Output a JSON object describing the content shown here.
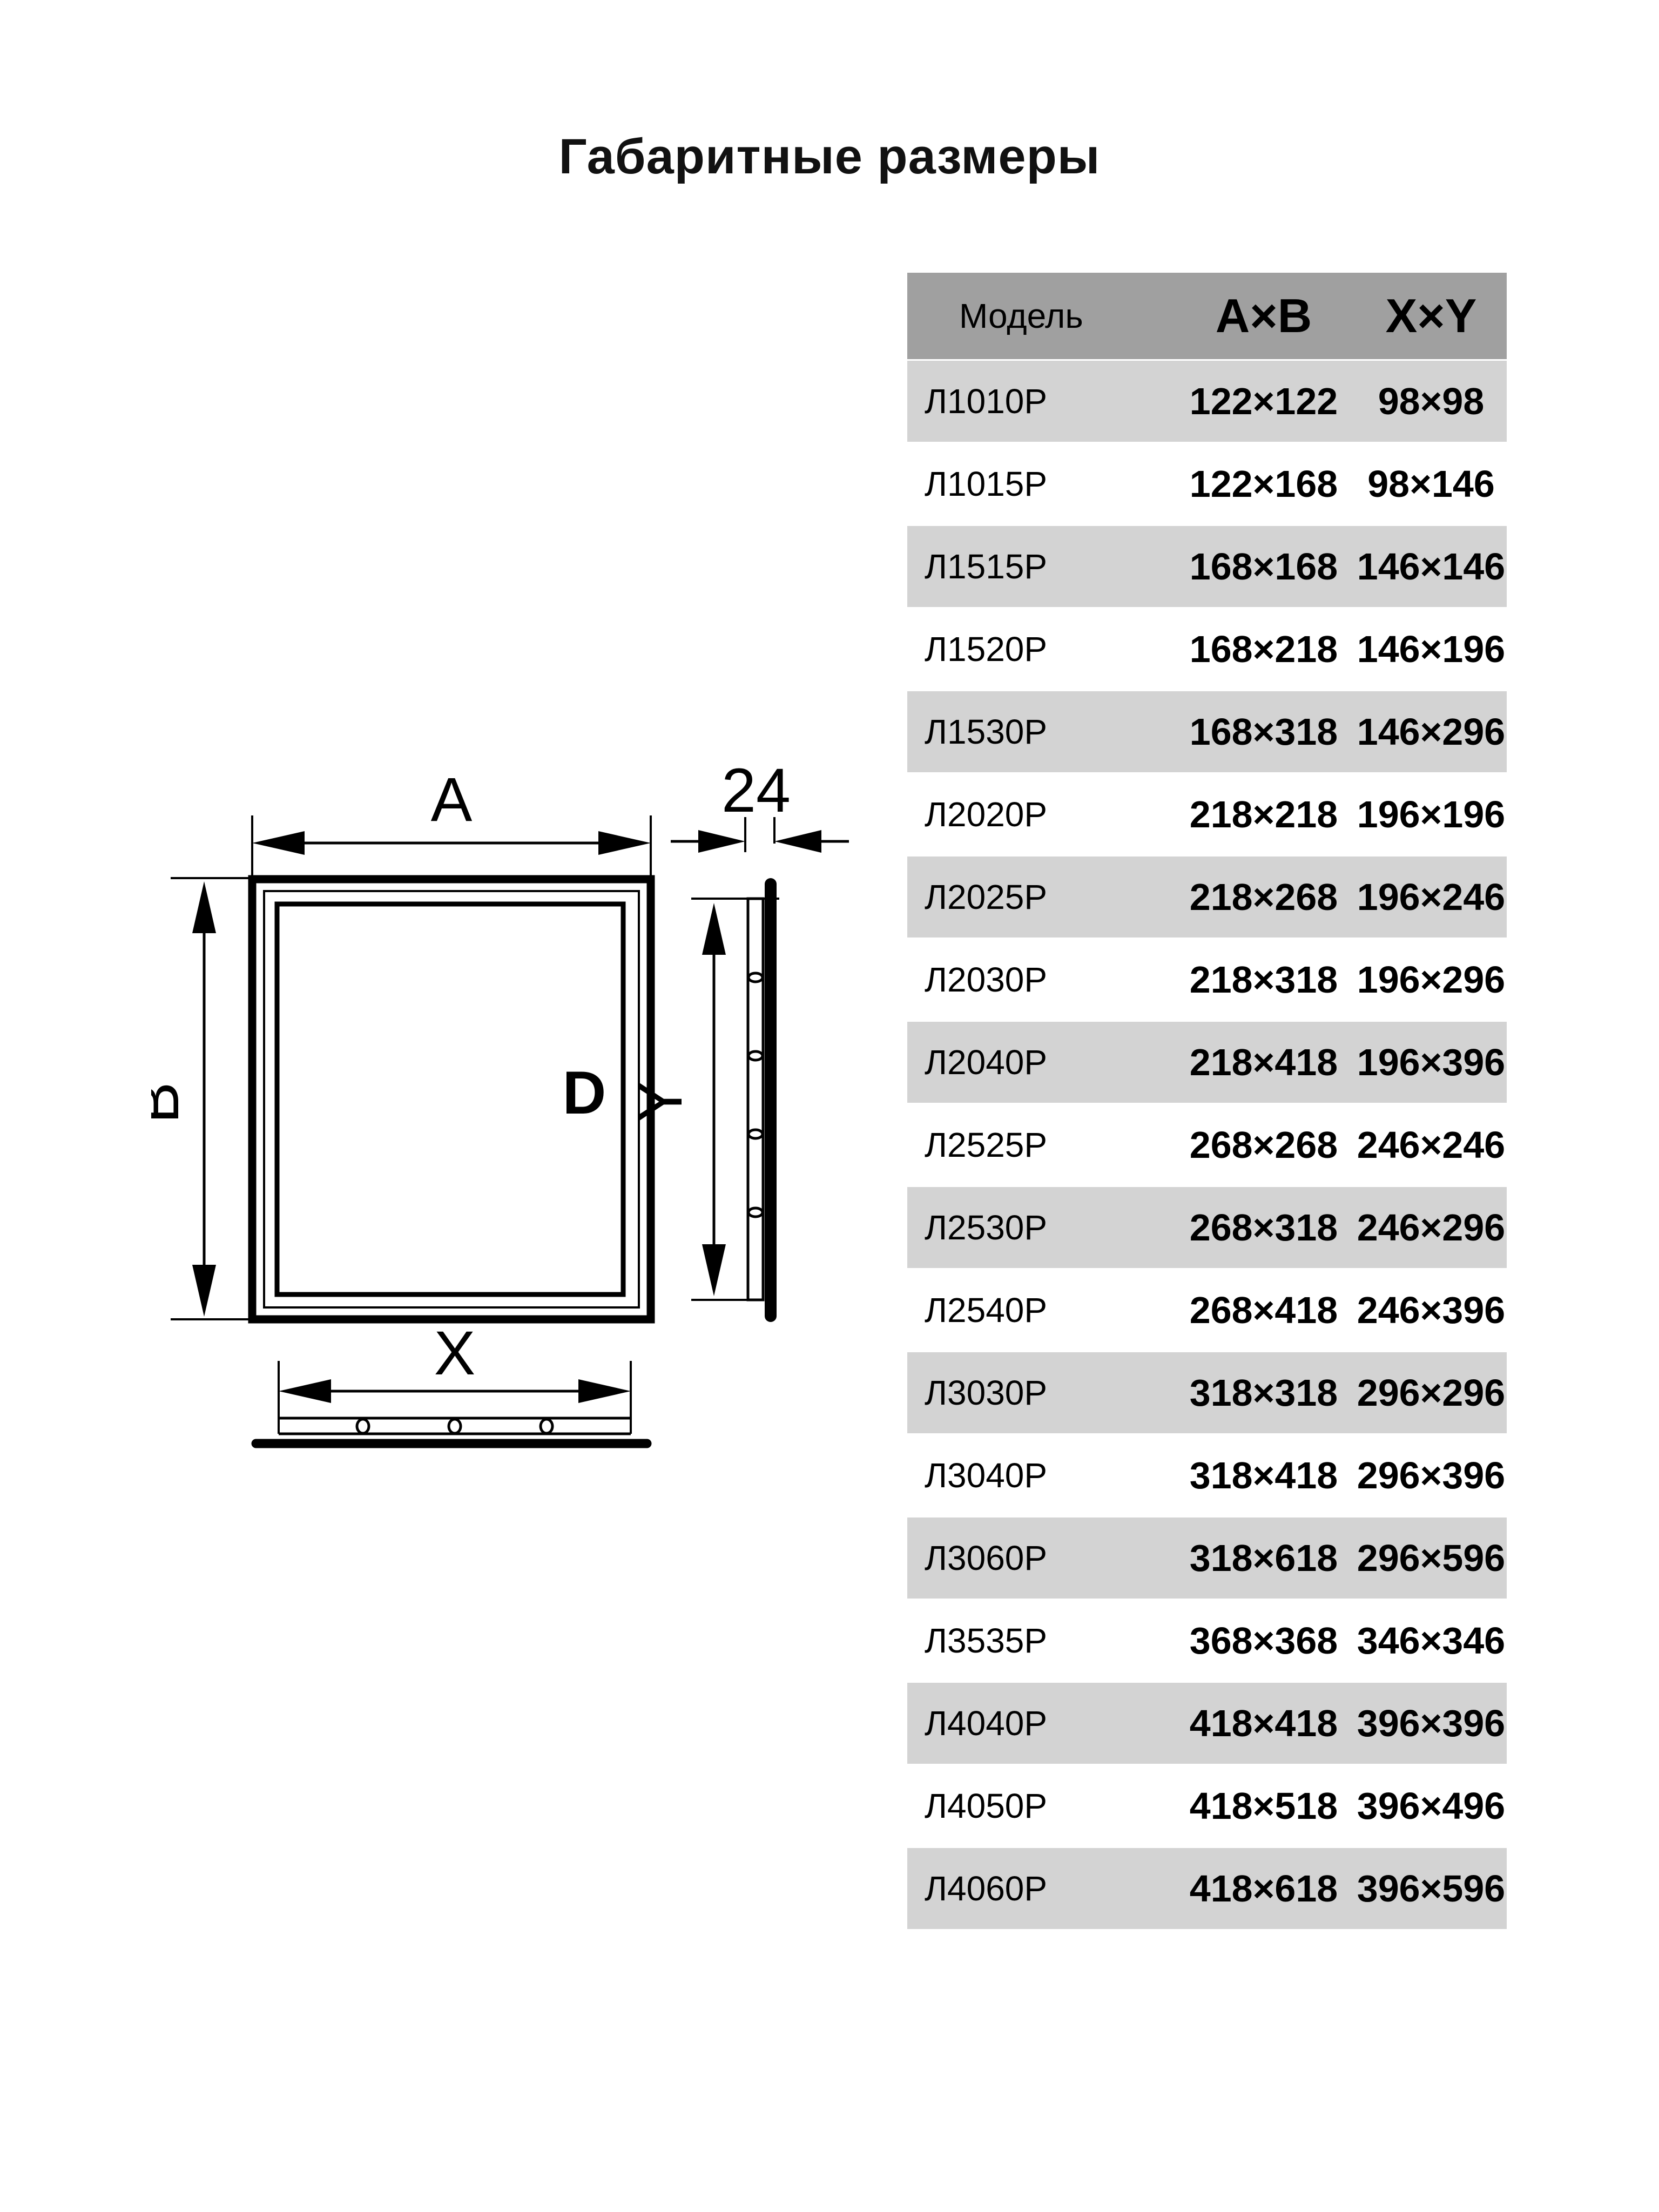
{
  "title": "Габаритные размеры",
  "table": {
    "columns": {
      "model": "Модель",
      "ab": "A×B",
      "xy": "X×Y"
    },
    "rows": [
      {
        "model": "Л1010Р",
        "ab": "122×122",
        "xy": "98×98"
      },
      {
        "model": "Л1015Р",
        "ab": "122×168",
        "xy": "98×146"
      },
      {
        "model": "Л1515Р",
        "ab": "168×168",
        "xy": "146×146"
      },
      {
        "model": "Л1520Р",
        "ab": "168×218",
        "xy": "146×196"
      },
      {
        "model": "Л1530Р",
        "ab": "168×318",
        "xy": "146×296"
      },
      {
        "model": "Л2020Р",
        "ab": "218×218",
        "xy": "196×196"
      },
      {
        "model": "Л2025Р",
        "ab": "218×268",
        "xy": "196×246"
      },
      {
        "model": "Л2030Р",
        "ab": "218×318",
        "xy": "196×296"
      },
      {
        "model": "Л2040Р",
        "ab": "218×418",
        "xy": "196×396"
      },
      {
        "model": "Л2525Р",
        "ab": "268×268",
        "xy": "246×246"
      },
      {
        "model": "Л2530Р",
        "ab": "268×318",
        "xy": "246×296"
      },
      {
        "model": "Л2540Р",
        "ab": "268×418",
        "xy": "246×396"
      },
      {
        "model": "Л3030Р",
        "ab": "318×318",
        "xy": "296×296"
      },
      {
        "model": "Л3040Р",
        "ab": "318×418",
        "xy": "296×396"
      },
      {
        "model": "Л3060Р",
        "ab": "318×618",
        "xy": "296×596"
      },
      {
        "model": "Л3535Р",
        "ab": "368×368",
        "xy": "346×346"
      },
      {
        "model": "Л4040Р",
        "ab": "418×418",
        "xy": "396×396"
      },
      {
        "model": "Л4050Р",
        "ab": "418×518",
        "xy": "396×496"
      },
      {
        "model": "Л4060Р",
        "ab": "418×618",
        "xy": "396×596"
      }
    ]
  },
  "drawing": {
    "labels": {
      "width": "A",
      "height": "B",
      "inner_width": "X",
      "inner_height": "Y",
      "door": "D",
      "depth": "24"
    }
  },
  "colors": {
    "header_bg": "#a0a0a0",
    "row_alt_bg": "#d3d3d3",
    "row_bg": "#ffffff",
    "ink": "#000000"
  }
}
